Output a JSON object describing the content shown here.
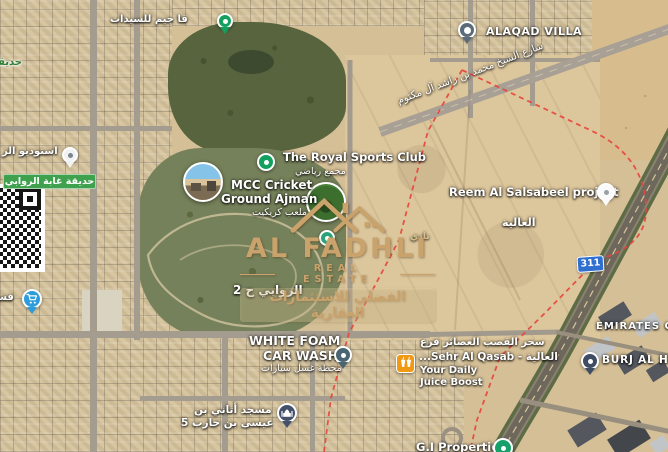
{
  "labels": {
    "gym": "قا جيم للسيدات",
    "park_fragment": "حديقة",
    "alaqad_villa": "ALAQAD VILLA",
    "street_name": "شارع الشيخ محمد بن راشد آل مكتوم",
    "studio": "استوديو الر",
    "garden_banner": "حديقة غابة الروابي",
    "royal_club_title": "The Royal Sports Club",
    "royal_club_subtitle": "مجمع رياضي",
    "mcc_line1": "MCC Cricket",
    "mcc_line2": "Ground Ajman",
    "mcc_subtitle": "ملعب كريكيت",
    "club_faint": "نادي",
    "area_rawabi2": "الروابي ح 2",
    "area_alia": "العالية",
    "reem_project": "Reem Al Salsabeel project",
    "route_badge": "311",
    "emirates": "EMIRATES C",
    "burj": "BURJ AL HA",
    "carwash_line1": "WHITE FOAM",
    "carwash_line2": "CAR WASH",
    "carwash_subtitle": "محطة غسل سيارات",
    "juice_line1": "سحر القصب العصائر فرع",
    "juice_line2": "...Sehr Al Qasab - العالية",
    "juice_line3": "Your Daily",
    "juice_line4": "Juice Boost",
    "mosque_line1": "مسجد أتاني بن",
    "mosque_line2": "عيسى بن حارب 5",
    "gi_properties": "G.I Properties",
    "grocery_fragment": "فستق"
  },
  "watermark": {
    "brand": "AL FADHLI",
    "tagline": "REAL ESTATE",
    "arabic_line": "الفضلي للاستثمارات العقارية",
    "gold": "#C9A36B"
  },
  "colors": {
    "boundary_red": "#E8453C",
    "route_badge_blue": "#2F6FD0",
    "pin_green": "#12A05F",
    "grocery_pin_blue": "#2D9CDB",
    "villa_pin_slate": "#5C6B78",
    "carwash_pin_teal": "#4A6572",
    "mosque_pin_navy": "#44516B",
    "burj_pin_navy": "#3F4C63",
    "gi_pin_green": "#17A06A",
    "juice_icon_orange": "#F29913",
    "garden_banner_green": "#3FA14E"
  },
  "icons": {
    "grocery_pin": "cart-icon",
    "mosque_pin": "mosque-icon",
    "juice_shop": "juice-cups-icon",
    "listing_qr": "qr-code-icon",
    "photos": "street-photo-circle"
  }
}
